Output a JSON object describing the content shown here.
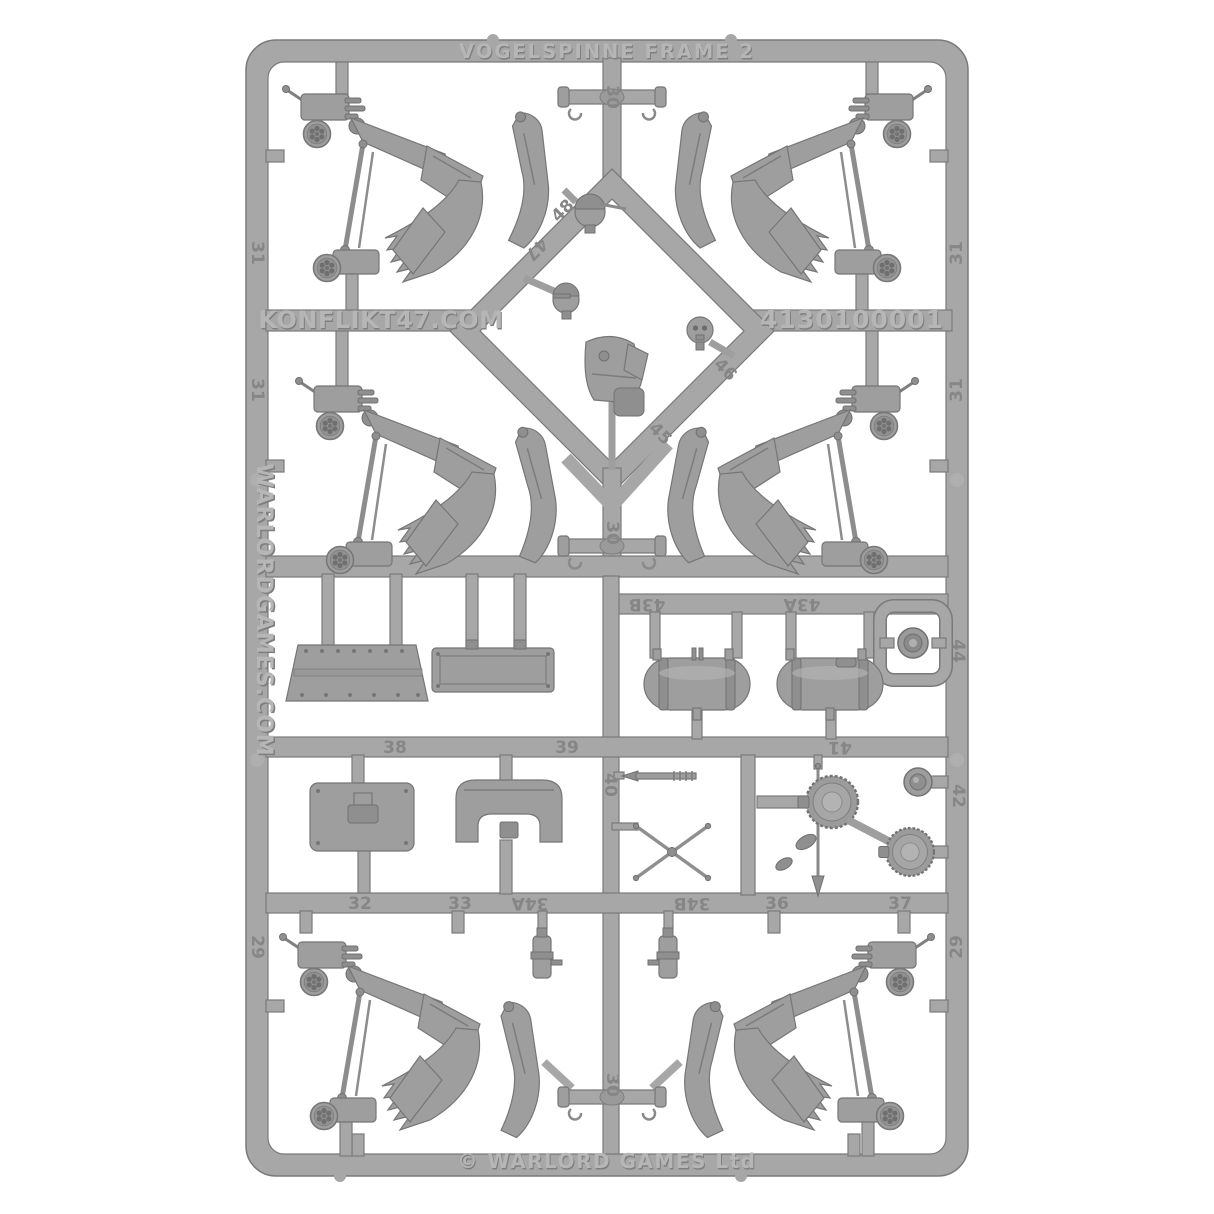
{
  "sprue": {
    "title": "VOGELSPINNE FRAME 2",
    "site_crossbar": "KONFLIKT47.COM",
    "product_code": "4130100001",
    "site_left_rail": "WARLORDGAMES.COM",
    "copyright": "© WARLORD GAMES Ltd"
  },
  "stamps": {
    "s30_top": "30",
    "s31_upper_left": "31",
    "s31_upper_right": "31",
    "s31_mid_left": "31",
    "s31_mid_right": "31",
    "s48": "48",
    "s47": "47",
    "s46": "46",
    "s45": "45",
    "s30_mid": "30",
    "s43b": "43B",
    "s43a": "43A",
    "s44": "44",
    "s38": "38",
    "s39": "39",
    "s40": "40",
    "s41": "41",
    "s42": "42",
    "s32": "32",
    "s33": "33",
    "s34a": "34A",
    "s34b": "34B",
    "s36": "36",
    "s37": "37",
    "s29_bottom_left": "29",
    "s29_bottom_right": "29",
    "s30_bottom": "30"
  },
  "colors": {
    "background": "#ffffff",
    "plastic": "#a7a7a7",
    "plastic_light": "#b2b2b2",
    "plastic_dark": "#8f8f8f",
    "plastic_edge": "#7a7a7a",
    "emboss_text": "#b6b6b6",
    "emboss_shadow": "#7f7f7f",
    "stamp_text": "#868686"
  }
}
